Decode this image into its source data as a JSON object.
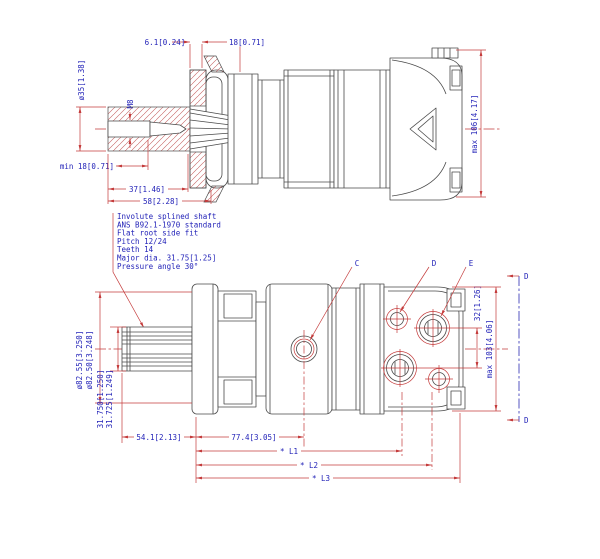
{
  "title": "Hydraulic motor dimensional drawing",
  "notes": {
    "lines": [
      "Involute splined shaft",
      "ANS B92.1-1970 standard",
      "Flat root side fit",
      "Pitch 12/24",
      "Teeth 14",
      "Major dia. 31.75[1.25]",
      "Pressure angle 30°"
    ]
  },
  "top_view": {
    "dims": {
      "flange_thickness": "6.1[0.24]",
      "pilot_length": "18[0.71]",
      "shaft_diameter": "ø35[1.38]",
      "thread_size": "M8",
      "thread_depth": "min 18[0.71]",
      "spline_length": "37[1.46]",
      "shaft_length": "58[2.28]",
      "overall_height": "max 106[4.17]"
    }
  },
  "bottom_view": {
    "dims": {
      "pilot_diameter_max": "ø82.55[3.250]",
      "pilot_diameter_min": "ø82.50[3.248]",
      "shaft_diameter_max": "31.750[1.250]",
      "shaft_diameter_min": "31.725[1.249]",
      "shaft_extension": "54.1[2.13]",
      "port_c_distance": "77.4[3.05]",
      "length_l1": "* L1",
      "length_l2": "* L2",
      "length_l3": "* L3",
      "port_spacing": "32[1.26]",
      "overall_width": "max 103[4.06]"
    },
    "port_labels": {
      "c": "C",
      "d": "D",
      "e": "E"
    },
    "section_label": "D"
  },
  "colors": {
    "dimension_red": "#c43b3b",
    "text_blue": "#2323b8",
    "geometry_gray": "#4a4a4a",
    "section_blue": "#4444bb"
  }
}
